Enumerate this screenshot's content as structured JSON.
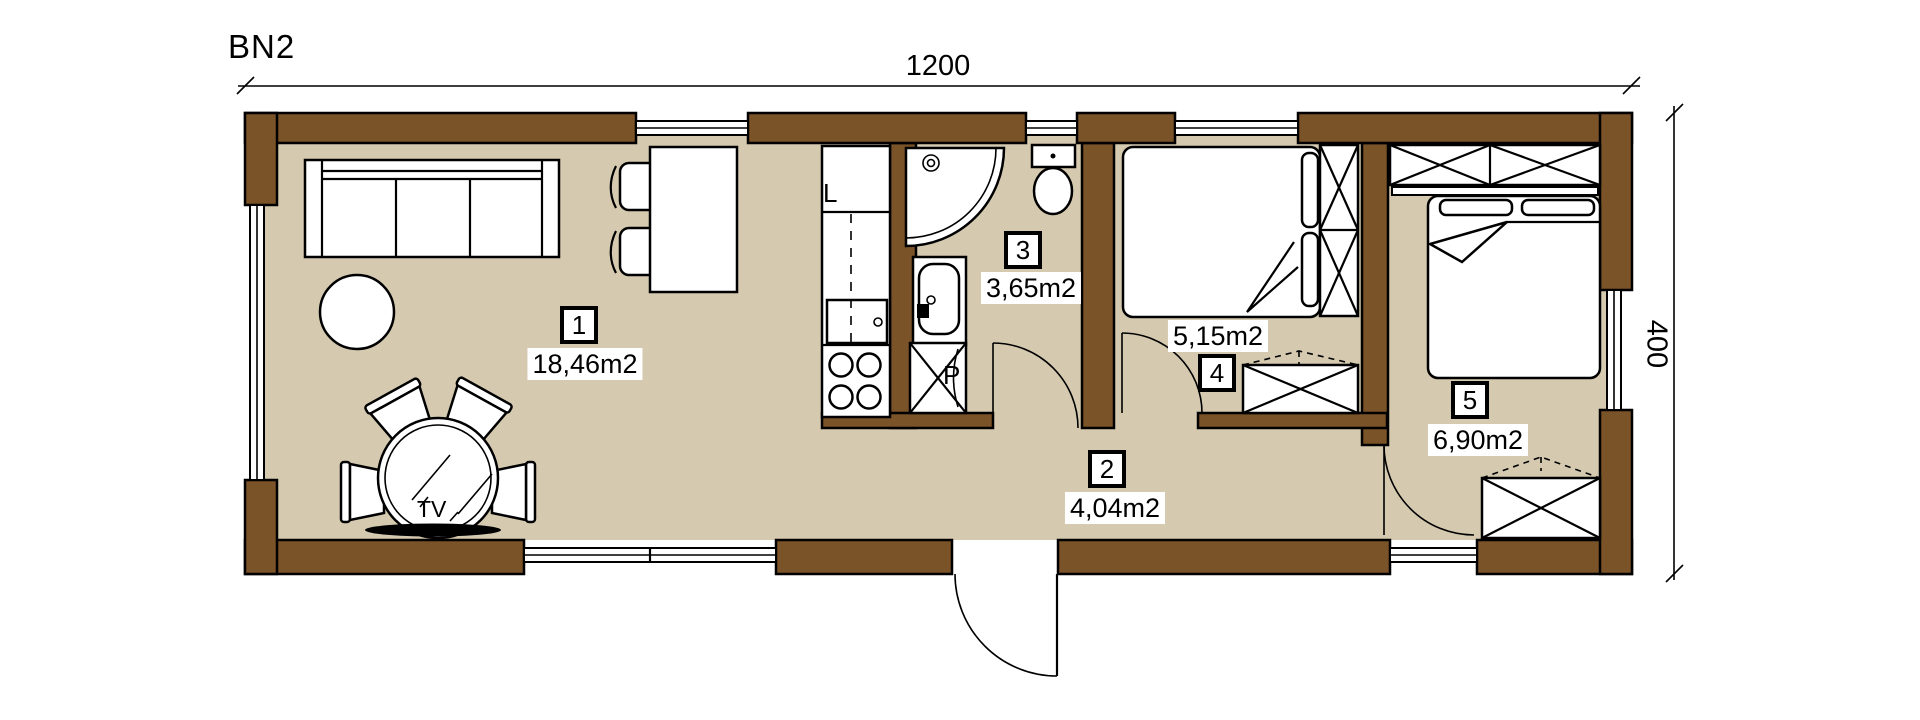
{
  "title": "BN2",
  "dimensions": {
    "width": "1200",
    "height": "400"
  },
  "rooms": [
    {
      "number": "1",
      "area": "18,46m2"
    },
    {
      "number": "2",
      "area": "4,04m2"
    },
    {
      "number": "3",
      "area": "3,65m2"
    },
    {
      "number": "4",
      "area": "5,15m2"
    },
    {
      "number": "5",
      "area": "6,90m2"
    }
  ],
  "fixtures": {
    "fridge": "L",
    "washing_machine": "P",
    "tv": "TV"
  },
  "colors": {
    "wall": "#7b5329",
    "floor": "#d5cab0",
    "line": "#000000"
  }
}
